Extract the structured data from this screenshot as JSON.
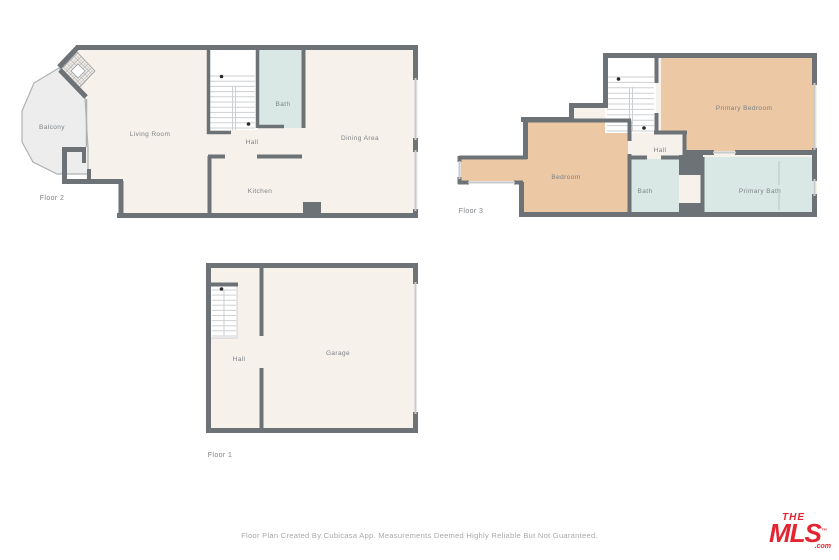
{
  "colors": {
    "wall": "#6d7276",
    "room_cream": "#f7f1eb",
    "bedroom_tan": "#ecc8a4",
    "bath_blue": "#d9e8e5",
    "balcony_gray": "#ededee",
    "stairs_white": "#ffffff",
    "window_light": "#c8cbcd",
    "label_gray": "#7d8287",
    "logo_red": "#e42430"
  },
  "floors": {
    "floor2": {
      "label": "Floor 2",
      "rooms": {
        "balcony": "Balcony",
        "living_room": "Living Room",
        "hall": "Hall",
        "bath": "Bath",
        "dining_area": "Dining Area",
        "kitchen": "Kitchen"
      }
    },
    "floor3": {
      "label": "Floor 3",
      "rooms": {
        "bedroom": "Bedroom",
        "hall": "Hall",
        "bath": "Bath",
        "primary_bedroom": "Primary Bedroom",
        "primary_bath": "Primary Bath"
      }
    },
    "floor1": {
      "label": "Floor 1",
      "rooms": {
        "hall": "Hall",
        "garage": "Garage"
      }
    }
  },
  "footer": {
    "disclaimer": "Floor Plan Created By Cubicasa App. Measurements Deemed Highly Reliable But Not Guaranteed."
  },
  "logo": {
    "the": "THE",
    "mls": "MLS",
    "tm": "™",
    "com": ".com"
  }
}
